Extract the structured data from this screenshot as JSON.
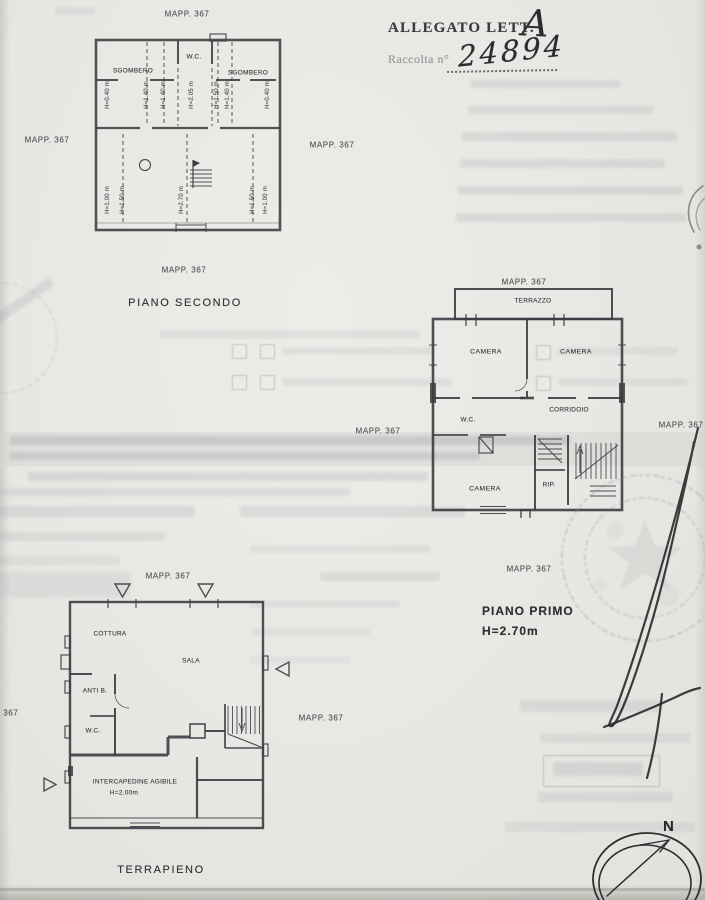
{
  "page": {
    "allegato_label": "ALLEGATO LETT.",
    "allegato_letter": "A",
    "raccolta_label": "Raccolta n°",
    "raccolta_number": "24894",
    "mapp": "MAPP. 367",
    "north": "N"
  },
  "piano_secondo": {
    "title": "PIANO SECONDO",
    "room_left": "SGOMBERO",
    "room_center": "W.C.",
    "room_right": "SGOMBERO",
    "heights_upper": [
      "H=0.40 m",
      "H=1.40 m",
      "H=1.40 m",
      "H=2.05 m",
      "H=1.50 m",
      "H=1.40 m",
      "H=0.40 m"
    ],
    "heights_lower": [
      "H=1.00 m",
      "H=1.50 m",
      "H=2.70 m",
      "H=1.50 m",
      "H=1.00 m"
    ]
  },
  "piano_primo": {
    "title": "PIANO PRIMO",
    "height_note": "H=2.70m",
    "terrazzo": "TERRAZZO",
    "camera_top_left": "CAMERA",
    "camera_top_right": "CAMERA",
    "wc": "W.C.",
    "corridoio": "CORRIDOIO",
    "camera_bottom": "CAMERA",
    "rip": "RIP."
  },
  "piano_terra": {
    "cottura": "COTTURA",
    "sala": "SALA",
    "anti_b": "ANTI B.",
    "wc": "W.C.",
    "intercapedine": "INTERCAPEDINE AGIBILE",
    "intercapedine_height": "H=2.00m",
    "terrapieno": "TERRAPIENO"
  }
}
